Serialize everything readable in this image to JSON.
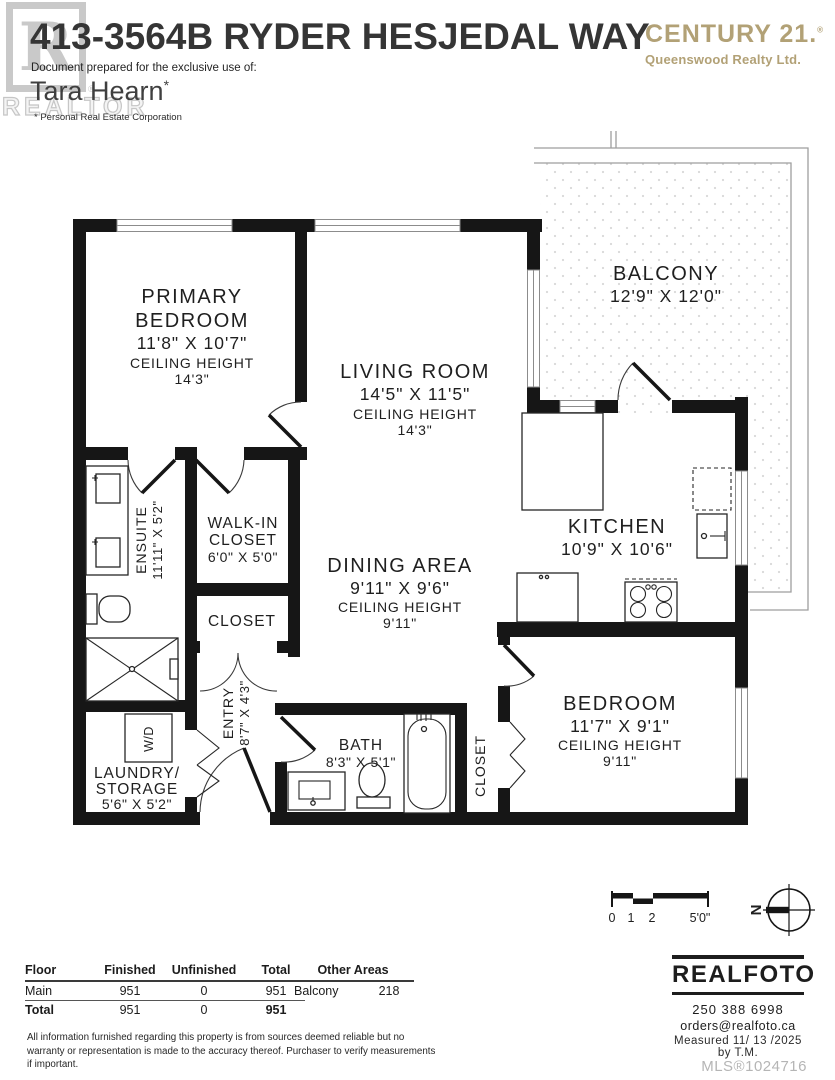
{
  "header": {
    "title": "413-3564B RYDER HESJEDAL WAY",
    "prepared_for": "Document prepared for the exclusive use of:",
    "agent_name": "Tara Hearn",
    "agent_mark": "*",
    "agent_subtitle": "* Personal Real Estate Corporation",
    "watermark_letter": "R",
    "watermark_word": "REALTOR",
    "watermark_reg": "®",
    "brand_name": "CENTURY 21.",
    "brand_reg": "®",
    "brand_sub": "Queenswood Realty Ltd.",
    "brand_color": "#b2a176"
  },
  "rooms": {
    "primary_bedroom": {
      "line1": "PRIMARY",
      "line2": "BEDROOM",
      "dims": "11'8\" X 10'7\"",
      "ch_label": "CEILING HEIGHT",
      "ch_value": "14'3\""
    },
    "living_room": {
      "name": "LIVING ROOM",
      "dims": "14'5\" X 11'5\"",
      "ch_label": "CEILING HEIGHT",
      "ch_value": "14'3\""
    },
    "balcony": {
      "name": "BALCONY",
      "dims": "12'9\" X 12'0\""
    },
    "ensuite": {
      "name": "ENSUITE",
      "dims": "11'11\" X 5'2\""
    },
    "walk_in_closet": {
      "line1": "WALK-IN",
      "line2": "CLOSET",
      "dims": "6'0\" X 5'0\""
    },
    "closet_hall": {
      "name": "CLOSET"
    },
    "dining_area": {
      "name": "DINING AREA",
      "dims": "9'11\" X 9'6\"",
      "ch_label": "CEILING HEIGHT",
      "ch_value": "9'11\""
    },
    "kitchen": {
      "name": "KITCHEN",
      "dims": "10'9\" X 10'6\""
    },
    "entry": {
      "name": "ENTRY",
      "dims": "8'7\" X 4'3\""
    },
    "bath": {
      "name": "BATH",
      "dims": "8'3\" X 5'1\""
    },
    "laundry": {
      "line1": "LAUNDRY/",
      "line2": "STORAGE",
      "dims": "5'6\" X 5'2\""
    },
    "closet_bedroom": {
      "name": "CLOSET"
    },
    "bedroom": {
      "name": "BEDROOM",
      "dims": "11'7\" X 9'1\"",
      "ch_label": "CEILING HEIGHT",
      "ch_value": "9'11\""
    },
    "washer_dryer": {
      "name": "W/D"
    }
  },
  "scale_bar": {
    "t0": "0",
    "t1": "1",
    "t2": "2",
    "t3": "5'0\""
  },
  "compass": {
    "label": "N"
  },
  "area_table": {
    "headers": {
      "floor": "Floor",
      "finished": "Finished",
      "unfinished": "Unfinished",
      "total": "Total"
    },
    "main_row": {
      "floor": "Main",
      "finished": "951",
      "unfinished": "0",
      "total": "951"
    },
    "total_row": {
      "floor": "Total",
      "finished": "951",
      "unfinished": "0",
      "total": "951"
    },
    "other_header": "Other Areas",
    "other_row": {
      "name": "Balcony",
      "value": "218"
    }
  },
  "disclaimer": {
    "line1": "All information furnished regarding this property is from sources deemed reliable but no",
    "line2": "warranty or representation is made to the accuracy thereof. Purchaser to verify measurements",
    "line3": "if important."
  },
  "footer": {
    "logo": "REALFOTO",
    "phone": "250 388 6998",
    "email": "orders@realfoto.ca",
    "measured": "Measured  11/ 13 /2025 by T.M.",
    "mls": "MLS®1024716"
  }
}
